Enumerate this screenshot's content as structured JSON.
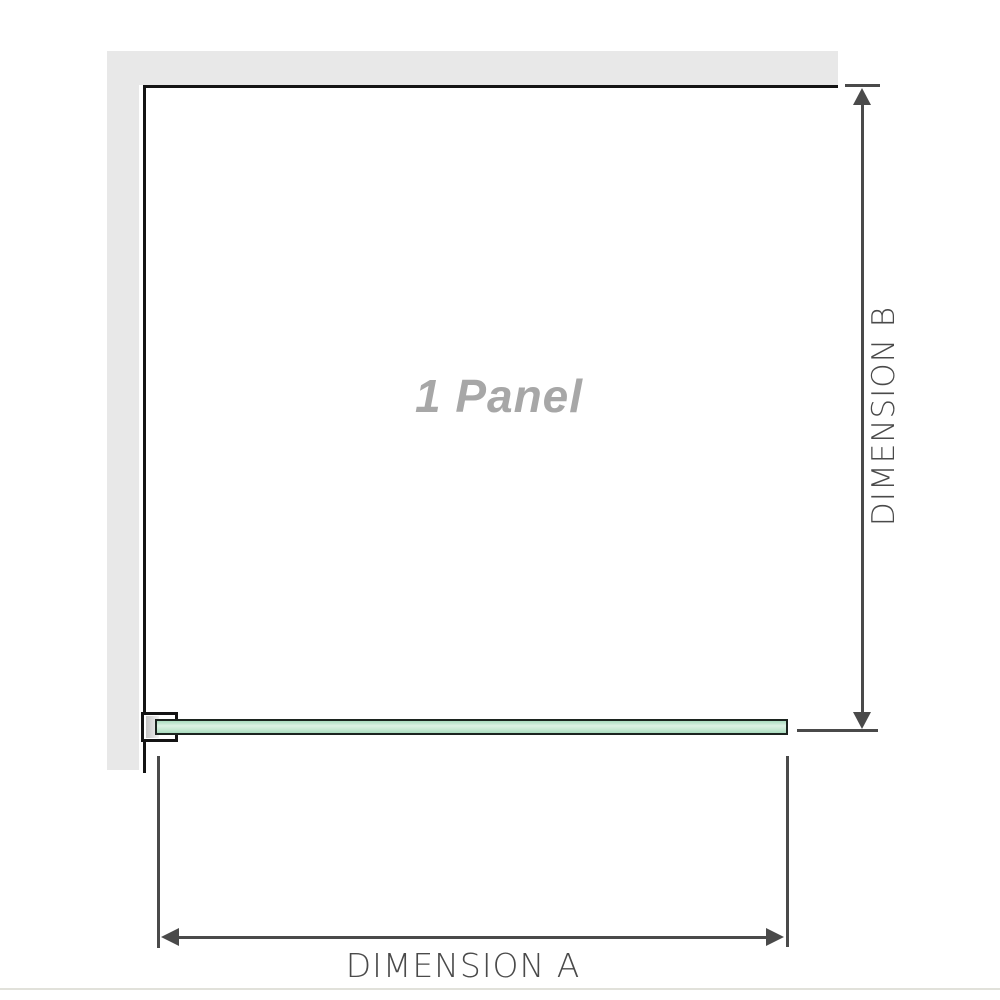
{
  "diagram": {
    "panel_label": "1 Panel",
    "dimension_a_label": "DIMENSION A",
    "dimension_b_label": "DIMENSION B"
  },
  "colors": {
    "wall": "#e8e8e8",
    "panel-edge": "#141414",
    "dimension": "#4a4a4a",
    "label-gray": "#a7a7a7",
    "glass-border": "#1c241f",
    "glass-light": "#ddf1e4",
    "glass-mid": "#aadcbf",
    "glass-mid2": "#c2e7d0",
    "bracket-pad": "#c4c4c4",
    "divider": "#e1e1da"
  }
}
